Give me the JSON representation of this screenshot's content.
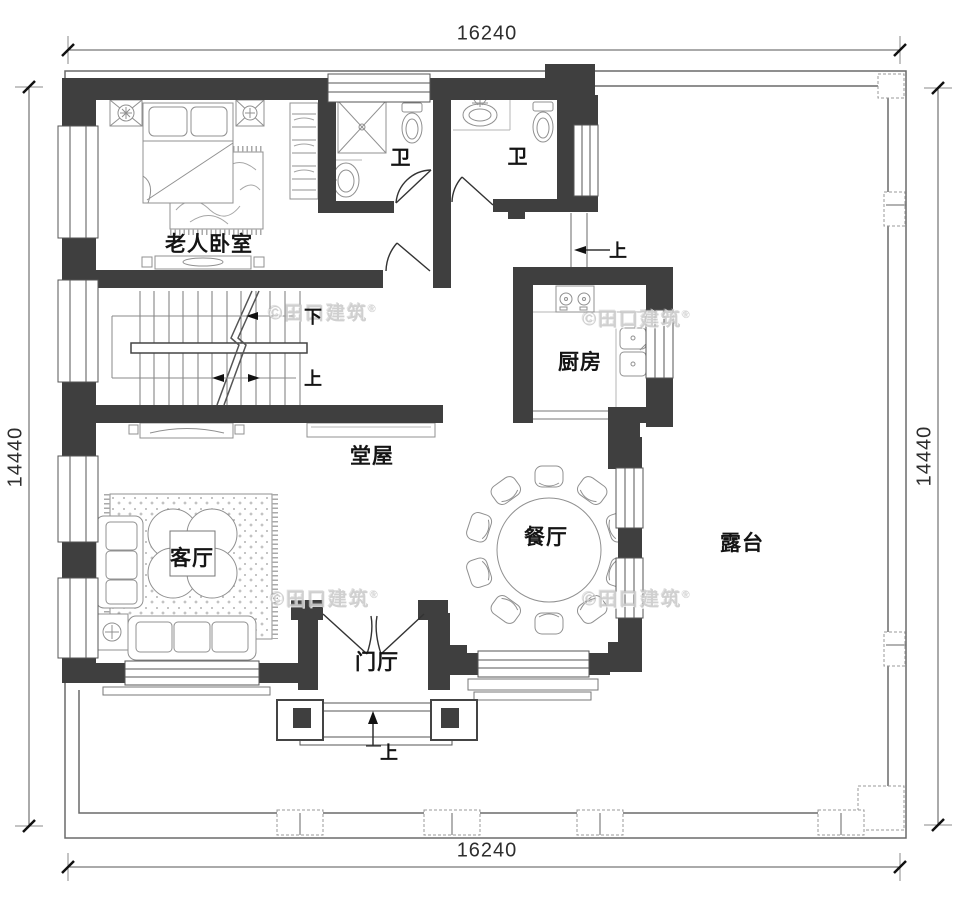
{
  "dimensions": {
    "top": "16240",
    "bottom": "16240",
    "left": "14440",
    "right": "14440"
  },
  "rooms": {
    "bedroom": {
      "label": "老人卧室"
    },
    "bath1": {
      "label": "卫"
    },
    "bath2": {
      "label": "卫"
    },
    "kitchen": {
      "label": "厨房"
    },
    "hall": {
      "label": "堂屋"
    },
    "living": {
      "label": "客厅"
    },
    "dining": {
      "label": "餐厅"
    },
    "foyer": {
      "label": "门厅"
    },
    "terrace": {
      "label": "露台"
    }
  },
  "annotations": {
    "stair_down": "下",
    "stair_up": "上",
    "side_entry_up": "上",
    "main_entry_up": "上"
  },
  "watermark": {
    "text": "©田口建筑",
    "reg": "®"
  },
  "colors": {
    "wall": "#3f3f3f",
    "thin_line": "#6a6a6a",
    "furniture_line": "#909090",
    "door_line": "#333333",
    "text": "#141414",
    "dimension": "#2e2e2e",
    "watermark": "#cccccc"
  }
}
